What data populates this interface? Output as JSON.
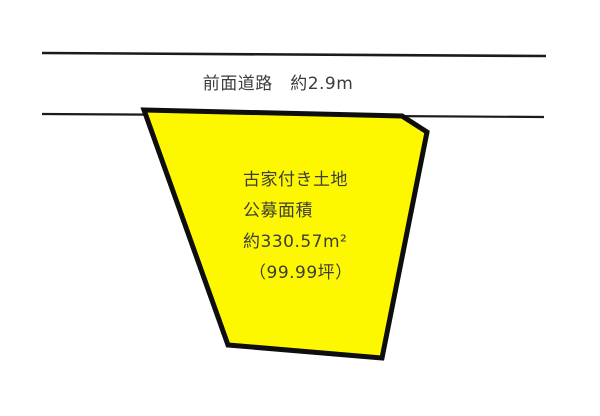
{
  "diagram": {
    "background_color": "#ffffff",
    "road": {
      "label": "前面道路　約2.9m",
      "line_color": "#1b1b1b"
    },
    "land": {
      "fill_color": "#fdf800",
      "stroke_color": "#0e0e0e",
      "labels": {
        "title": "古家付き土地",
        "area_type": "公募面積",
        "area_value": "約330.57m²",
        "tsubo_value": "（99.99坪）"
      }
    },
    "text_color": "#3c3c3c"
  }
}
